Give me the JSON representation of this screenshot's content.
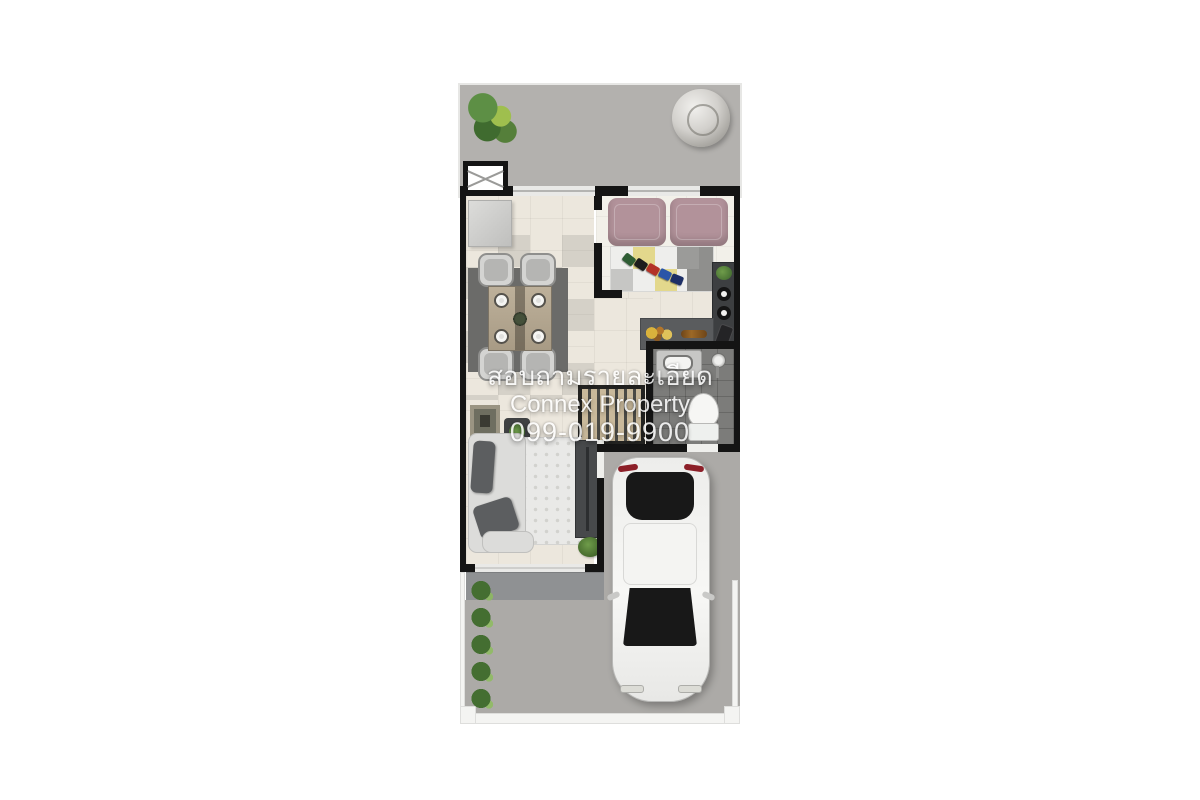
{
  "watermark": {
    "line1": "สอบถามรายละเอียด",
    "line2": "Connex Property",
    "line3": "099-019-9900"
  },
  "colors": {
    "page_bg": "#ffffff",
    "outdoor_concrete": "#b3b1ae",
    "driveway": "#acaaa7",
    "porch": "#8f9193",
    "interior_floor": "#ece7dd",
    "bedroom_floor": "#f2f0e9",
    "bathroom_floor": "#7c7c7a",
    "wall": "#141414",
    "window_fill": "#e9e9e7",
    "dining_rug": "#6b6b69",
    "sofa_mauve": "#b2929a",
    "rug_yellow": "#e3d88c",
    "sofa_gray_dark": "#5c5e60",
    "sofa_base": "#dcdcda",
    "stair_tread": "#c9b99b",
    "plant_green": "#4c7a38",
    "car_body": "#f0f0ee",
    "glass_dark": "#181818",
    "fence_white": "#f4f4f2",
    "watermark_color": "#ffffff"
  },
  "plan": {
    "scene": "townhouse-floor-plan-top-view",
    "objects": [
      "potted-plant",
      "water-tank",
      "utility-shaft-box",
      "kitchen-counter",
      "dining-table",
      "dining-chairs",
      "dining-rug",
      "bed-cushions",
      "play-rug",
      "toy-train",
      "kitchen-console",
      "stove-burners",
      "food-counter",
      "bathroom-sink",
      "shower",
      "toilet",
      "staircase",
      "l-shaped-sofa",
      "area-rug",
      "tv-console",
      "side-table",
      "wall-art",
      "plant-pot",
      "front-porch",
      "car",
      "shrub-row",
      "fence-posts"
    ]
  }
}
